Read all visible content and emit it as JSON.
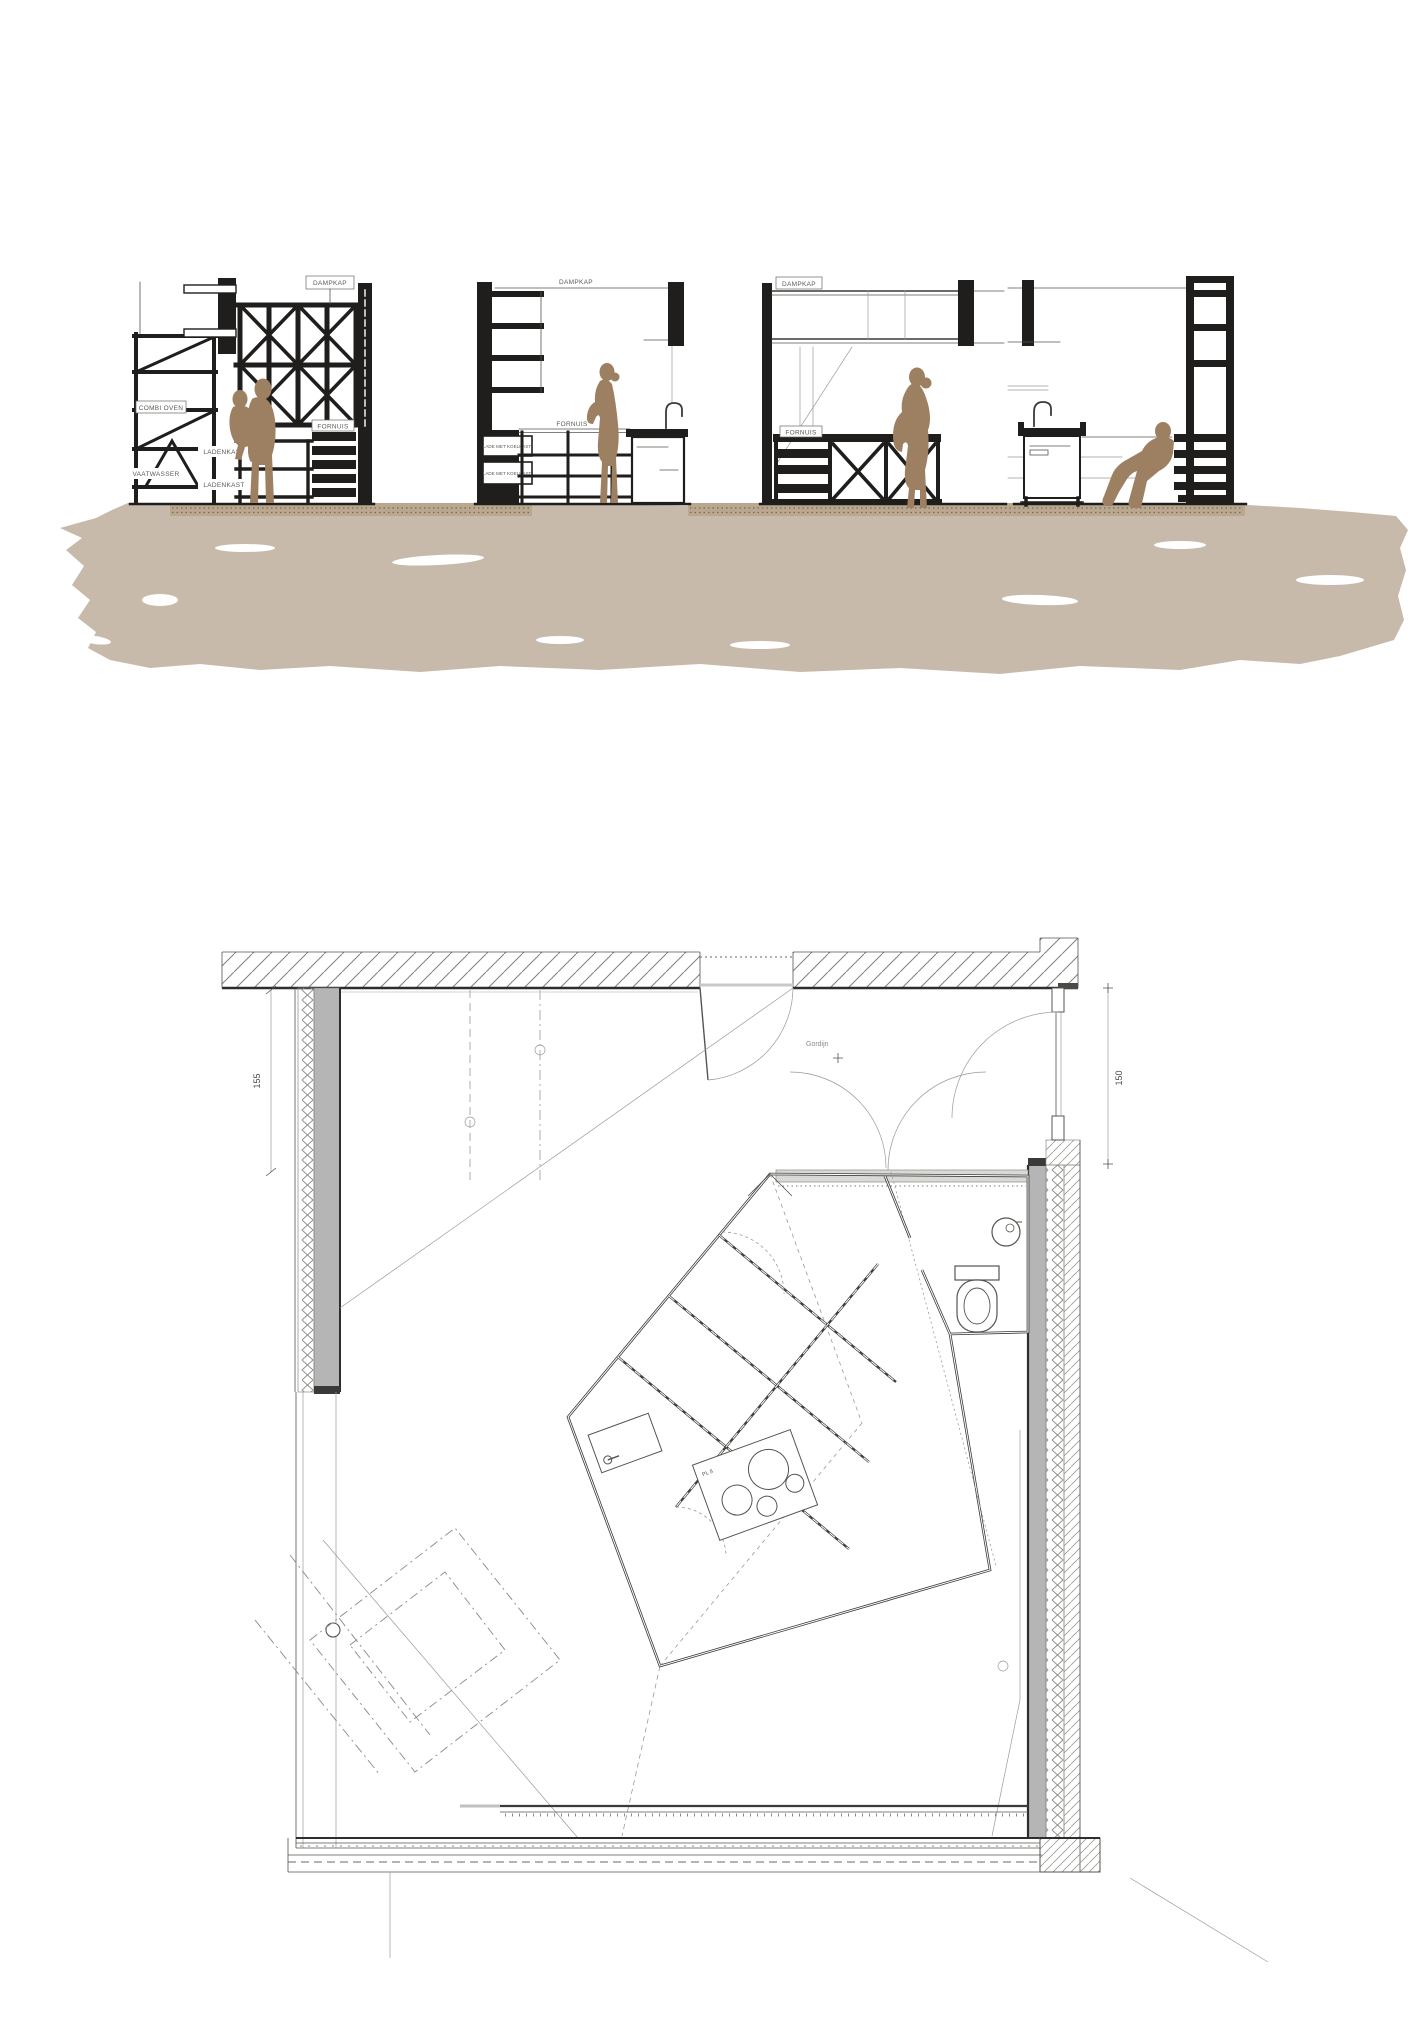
{
  "colors": {
    "figure": "#9d7f61",
    "ground": "#c7baab",
    "ground_strip": "#b9a78f",
    "ground_dots": "#7d6850",
    "wall_gray": "#b5b5b5",
    "ink": "#1f1e1c"
  },
  "sections": {
    "dampkap_label": "DAMPKAP",
    "combi_oven_label": "COMBI OVEN",
    "vaatwasser_label": "VAATWASSER",
    "ladenkast_label": "LADENKAST",
    "fornuis_label": "FORNUIS",
    "koelkast_drawer_label": "LADE MET KOELKAST"
  },
  "plan": {
    "left_dimension": "155",
    "right_dimension": "150",
    "door_annotation": "Gordijn",
    "cooktop_annotation": "PL 8"
  }
}
